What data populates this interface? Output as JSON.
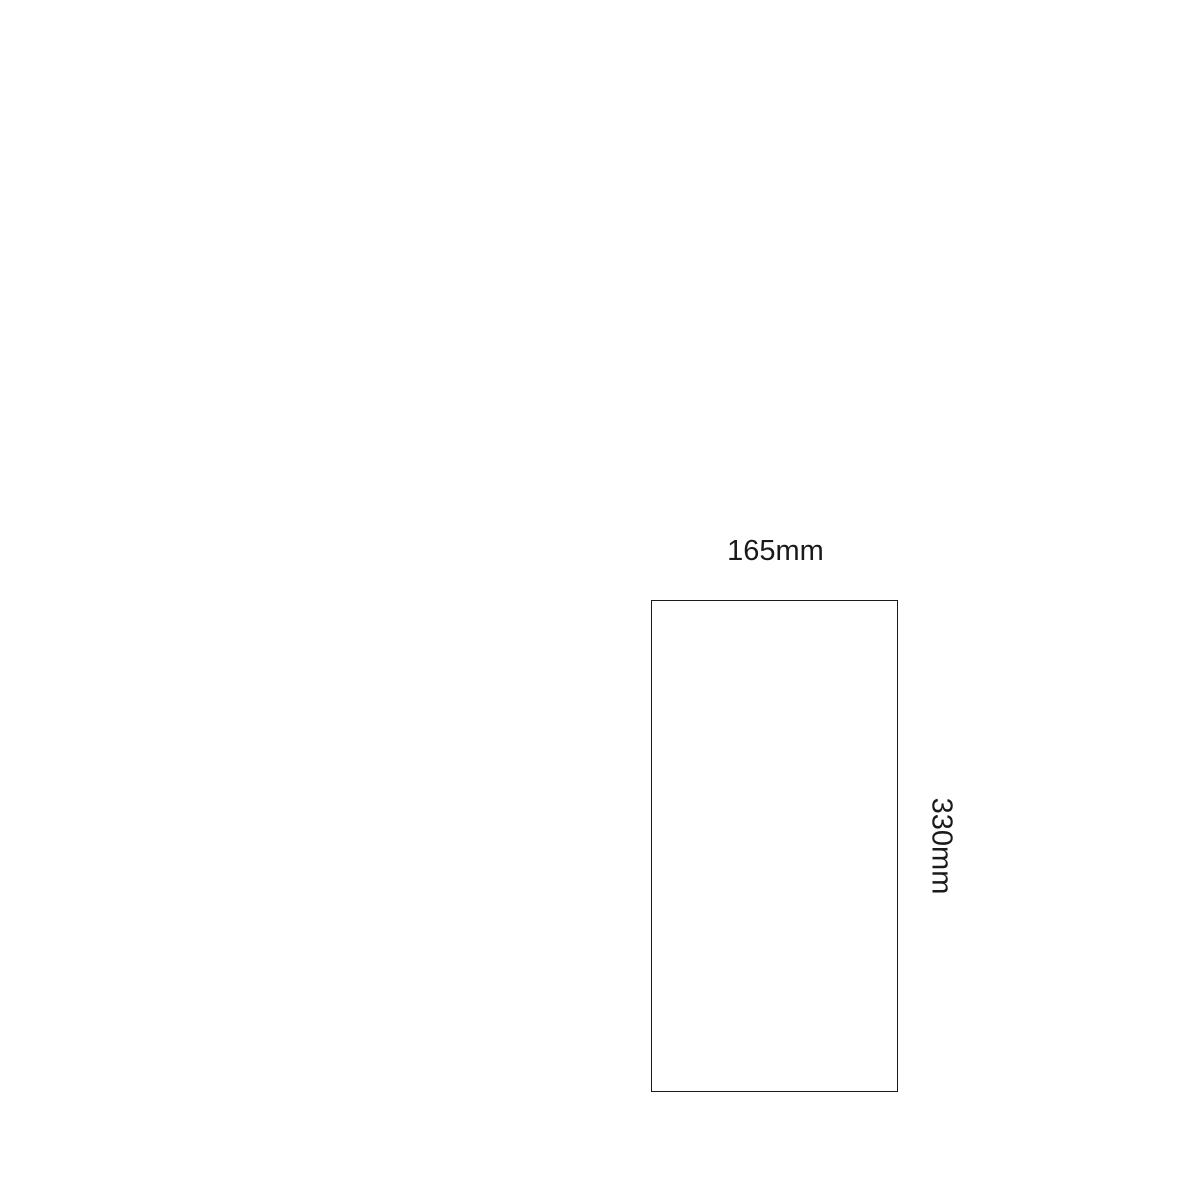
{
  "diagram": {
    "type": "dimension-diagram",
    "shape": "rectangle",
    "width_label": "165mm",
    "height_label": "330mm",
    "colors": {
      "background": "#ffffff",
      "outline": "#1a1a1a",
      "text": "#1a1a1a"
    }
  }
}
